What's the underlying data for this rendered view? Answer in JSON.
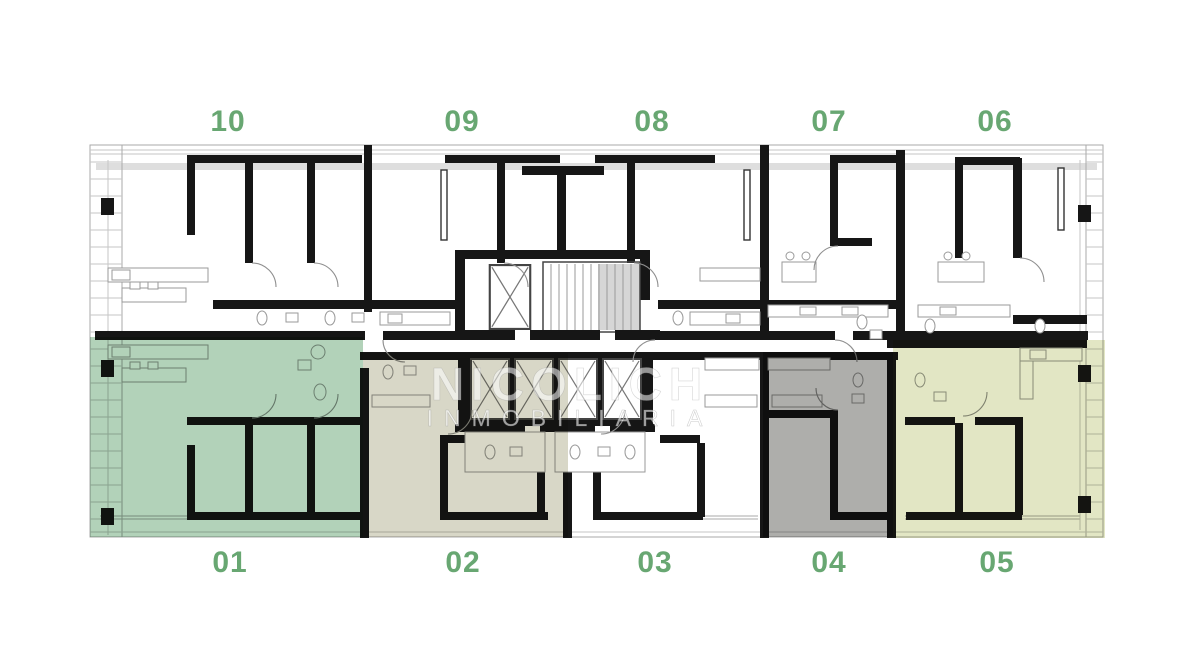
{
  "units": {
    "top": [
      {
        "label": "10"
      },
      {
        "label": "09"
      },
      {
        "label": "08"
      },
      {
        "label": "07"
      },
      {
        "label": "06"
      }
    ],
    "bottom": [
      {
        "label": "01"
      },
      {
        "label": "02"
      },
      {
        "label": "03"
      },
      {
        "label": "04"
      },
      {
        "label": "05"
      }
    ]
  },
  "label_color": "#68a772",
  "highlighted_units": [
    {
      "unit": "01",
      "color": "#b2d2b9"
    },
    {
      "unit": "02",
      "color": "#d8d7c7"
    },
    {
      "unit": "04",
      "color": "#aeaeab"
    },
    {
      "unit": "05",
      "color": "#e2e6c4"
    }
  ],
  "watermark": {
    "line1": "NICOLICH",
    "line2": "INMOBILIARIA"
  }
}
